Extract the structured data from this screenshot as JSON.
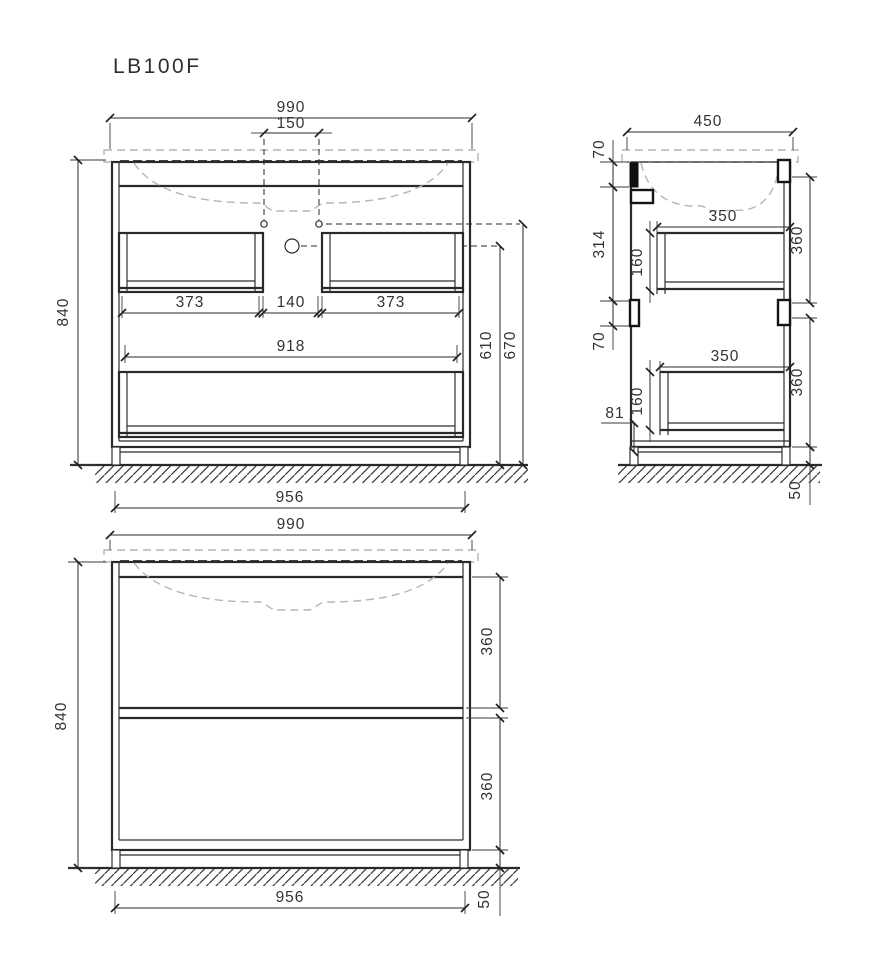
{
  "title": "LB100F",
  "front_open": {
    "width": "990",
    "faucet_spacing": "150",
    "height": "840",
    "drawer_left_width": "373",
    "drawer_gap": "140",
    "drawer_right_width": "373",
    "inner_width": "918",
    "drain_height": "610",
    "faucet_height": "670",
    "base_width": "956"
  },
  "side": {
    "depth": "450",
    "top_bracket": "70",
    "bracket_spacing": "314",
    "lower_bracket": "70",
    "upper_drawer_depth": "350",
    "upper_drawer_height": "160",
    "upper_front_height": "360",
    "lower_drawer_depth": "350",
    "lower_drawer_height": "160",
    "lower_front_height": "360",
    "bottom_clearance": "81",
    "plinth_height": "50"
  },
  "front_closed": {
    "width": "990",
    "height": "840",
    "upper_front_height": "360",
    "lower_front_height": "360",
    "base_width": "956",
    "plinth_height": "50"
  }
}
